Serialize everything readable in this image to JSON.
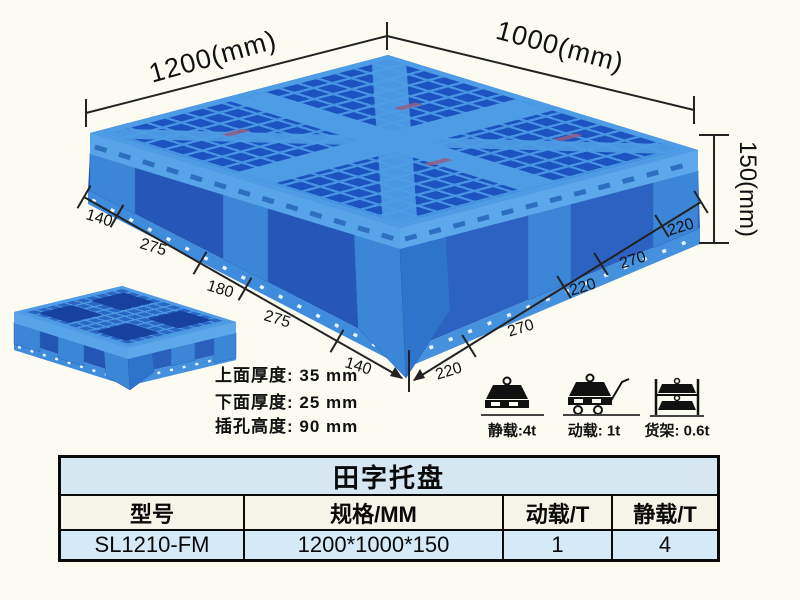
{
  "illustration": {
    "dim_length": "1200(mm)",
    "dim_width": "1000(mm)",
    "dim_height": "150(mm)",
    "left_chain": [
      "140",
      "275",
      "180",
      "275",
      "140"
    ],
    "right_chain": [
      "220",
      "270",
      "220",
      "270",
      "220"
    ],
    "notes": {
      "top": "上面厚度: 35 mm",
      "bottom": "下面厚度: 25 mm",
      "slot": "插孔高度: 90 mm"
    },
    "loads": {
      "static": "静载:4t",
      "dynamic": "动载: 1t",
      "rack": "货架: 0.6t"
    },
    "colors": {
      "pallet_blue": "#3c86d8",
      "pallet_dark": "#1d53c0",
      "pallet_light": "#4e9ce6",
      "dim_line": "#222222"
    }
  },
  "table": {
    "title": "田字托盘",
    "headers": [
      "型号",
      "规格/MM",
      "动载/T",
      "静载/T"
    ],
    "row": [
      "SL1210-FM",
      "1200*1000*150",
      "1",
      "4"
    ],
    "colors": {
      "title_bg": "#d7e7f2",
      "header_bg": "#f6f3e9",
      "row_bg": "#d4eaf7"
    }
  }
}
